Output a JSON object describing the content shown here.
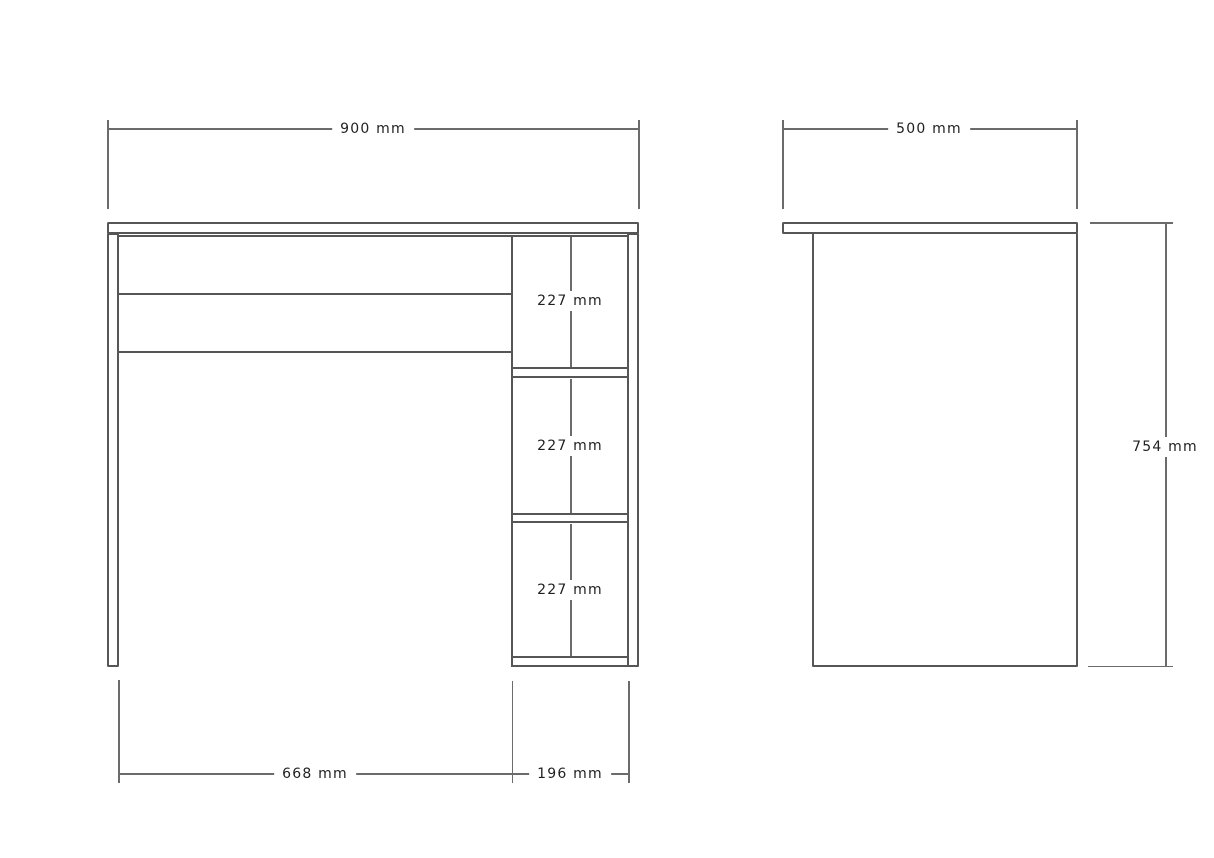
{
  "dims": {
    "front_width": "900 mm",
    "opening_width": "668 mm",
    "shelf_width": "196 mm",
    "compartments": [
      "227 mm",
      "227 mm",
      "227 mm"
    ],
    "side_depth": "500 mm",
    "side_height": "754 mm"
  },
  "colors": {
    "background": "#ffffff",
    "part_line": "#565656",
    "dimension_line": "#6b6b6b",
    "label_text": "#212121"
  }
}
